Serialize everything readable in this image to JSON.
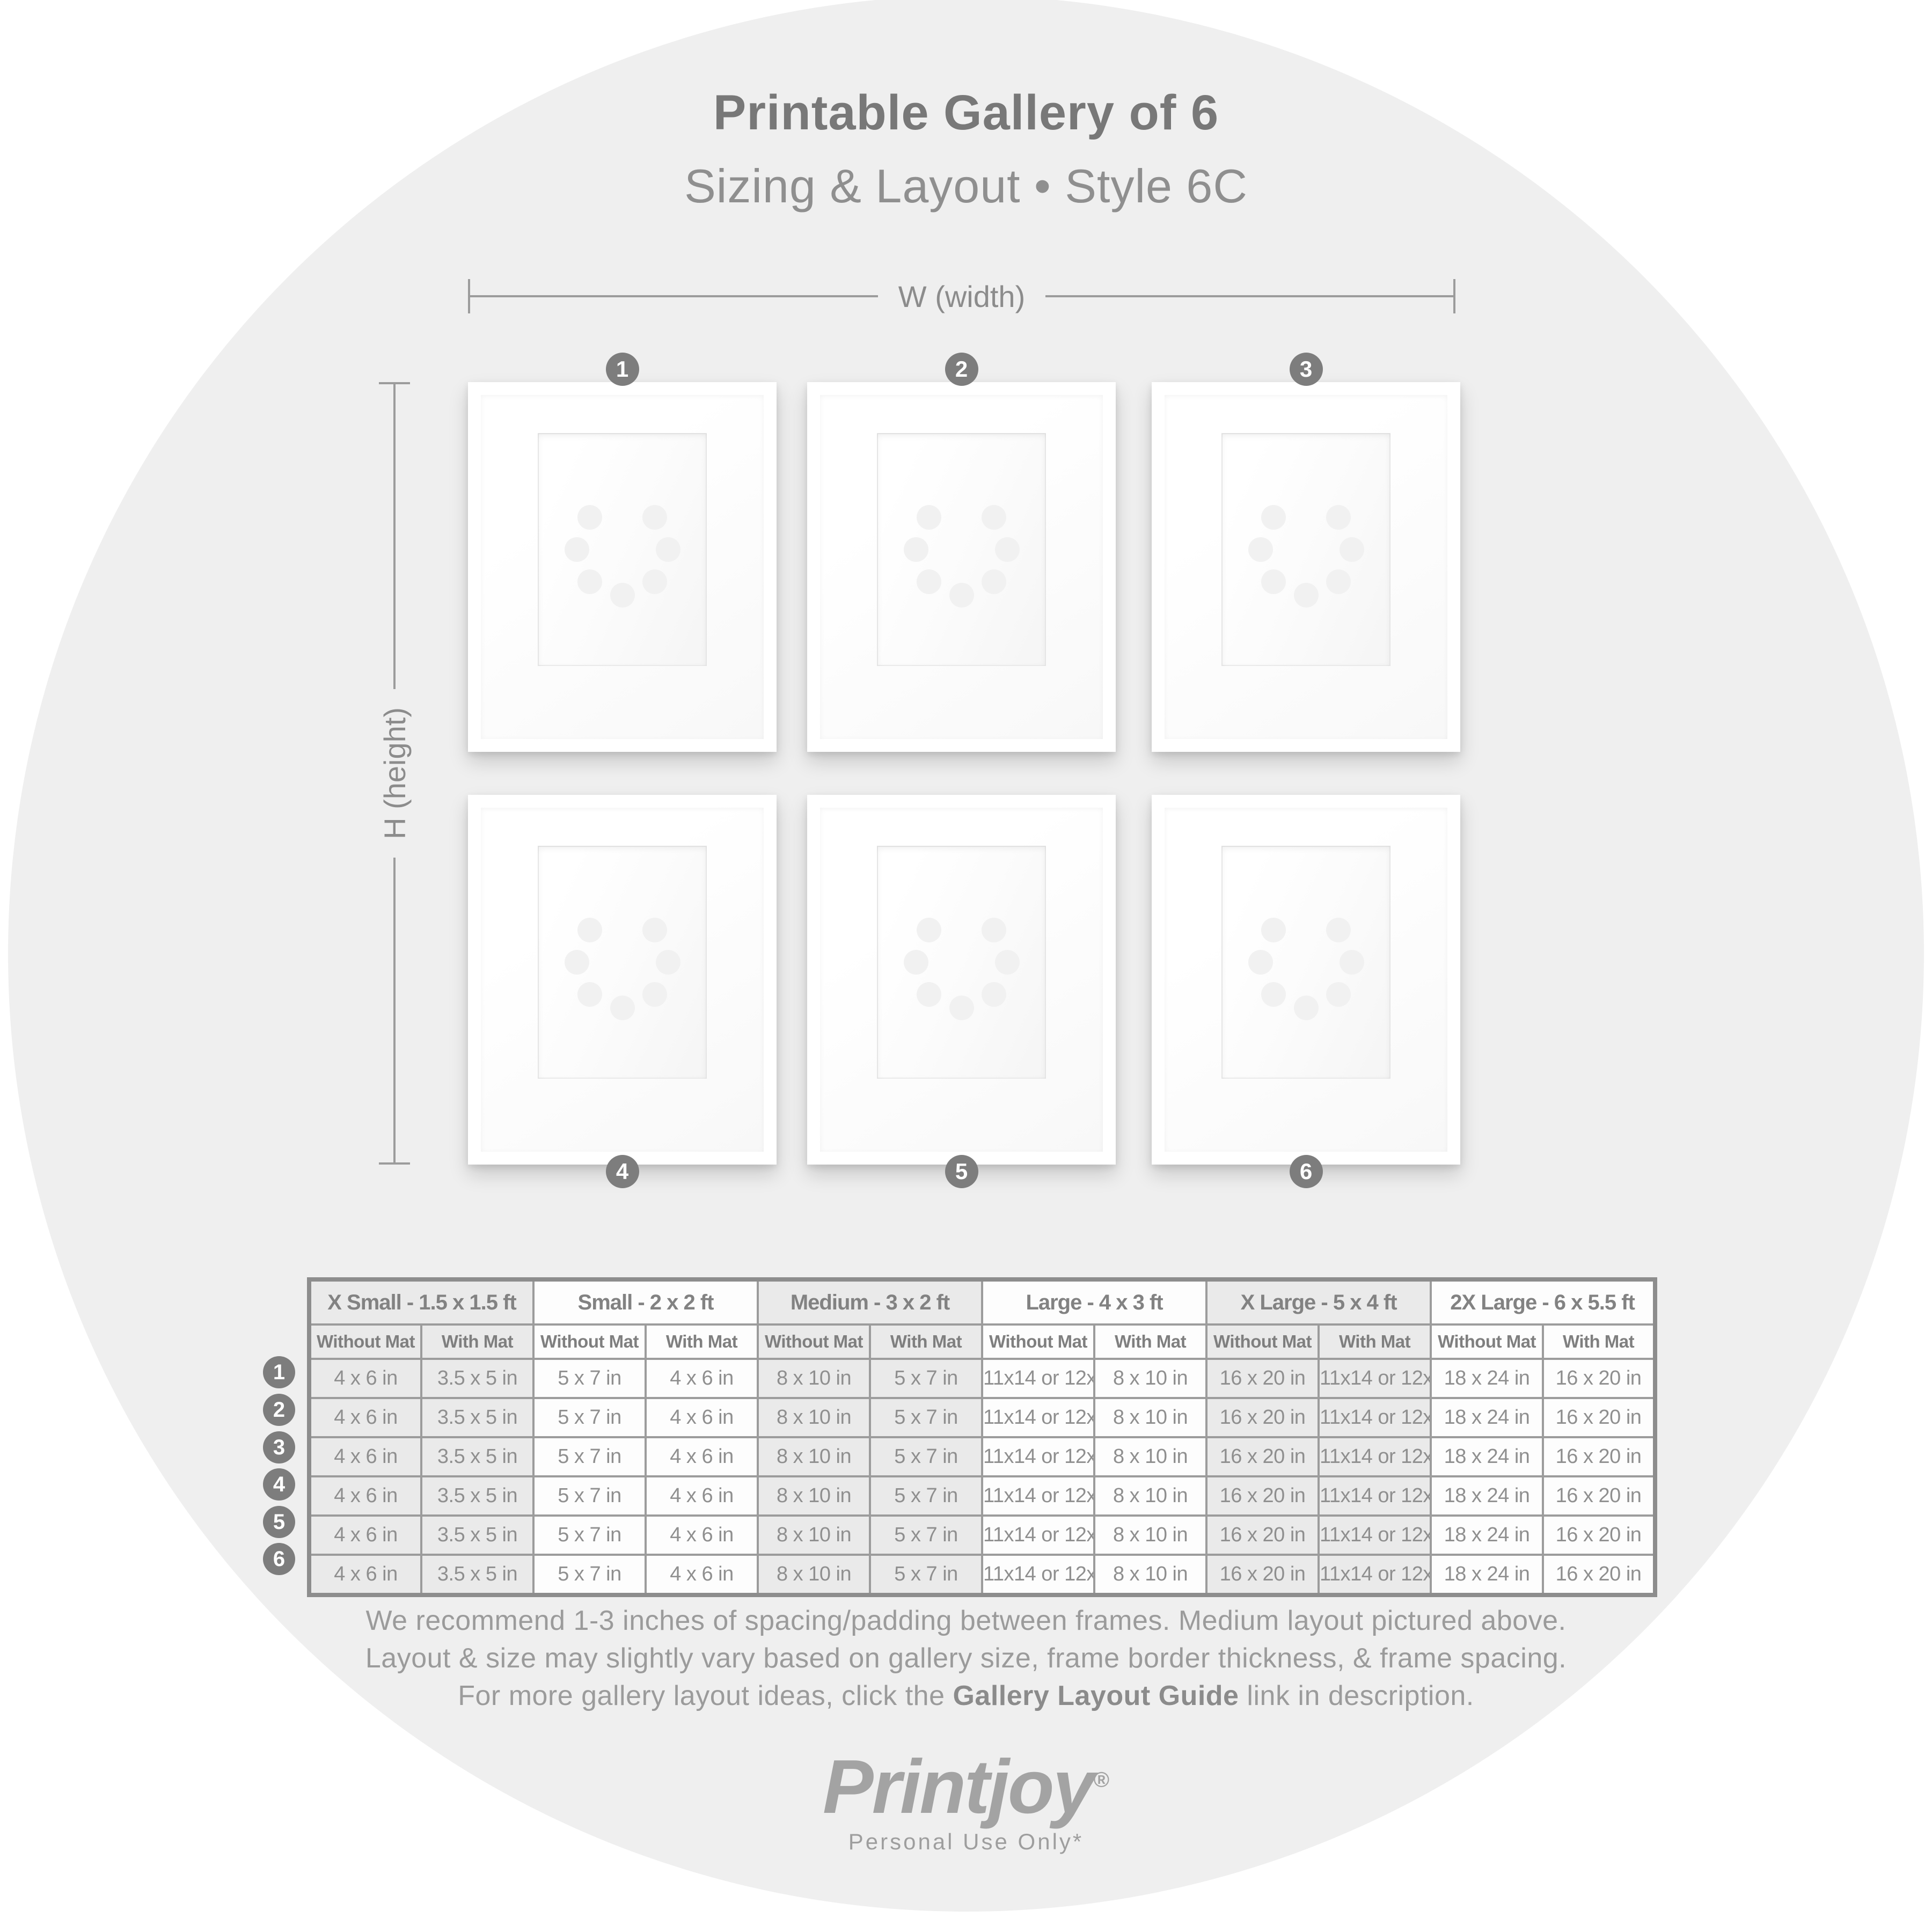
{
  "header": {
    "title": "Printable Gallery of 6",
    "subtitle": "Sizing & Layout • Style 6C"
  },
  "diagram": {
    "width_label": "W (width)",
    "height_label": "H (height)",
    "frames": [
      {
        "number": "1"
      },
      {
        "number": "2"
      },
      {
        "number": "3"
      },
      {
        "number": "4"
      },
      {
        "number": "5"
      },
      {
        "number": "6"
      }
    ]
  },
  "table": {
    "groups": [
      {
        "label": "X Small - 1.5 x 1.5 ft",
        "shaded": true
      },
      {
        "label": "Small - 2 x 2 ft",
        "shaded": false
      },
      {
        "label": "Medium - 3 x 2 ft",
        "shaded": true
      },
      {
        "label": "Large - 4 x 3 ft",
        "shaded": false
      },
      {
        "label": "X Large - 5 x 4 ft",
        "shaded": true
      },
      {
        "label": "2X Large - 6 x 5.5 ft",
        "shaded": false
      }
    ],
    "subheaders": [
      "Without Mat",
      "With Mat"
    ],
    "rows": [
      {
        "number": "1",
        "cells": [
          "4 x 6 in",
          "3.5 x 5 in",
          "5 x 7 in",
          "4 x 6 in",
          "8 x 10 in",
          "5 x 7 in",
          "11x14 or 12x16 in",
          "8 x 10 in",
          "16 x 20 in",
          "11x14 or 12x16 in",
          "18 x 24 in",
          "16 x 20 in"
        ]
      },
      {
        "number": "2",
        "cells": [
          "4 x 6 in",
          "3.5 x 5 in",
          "5 x 7 in",
          "4 x 6 in",
          "8 x 10 in",
          "5 x 7 in",
          "11x14 or 12x16 in",
          "8 x 10 in",
          "16 x 20 in",
          "11x14 or 12x16 in",
          "18 x 24 in",
          "16 x 20 in"
        ]
      },
      {
        "number": "3",
        "cells": [
          "4 x 6 in",
          "3.5 x 5 in",
          "5 x 7 in",
          "4 x 6 in",
          "8 x 10 in",
          "5 x 7 in",
          "11x14 or 12x16 in",
          "8 x 10 in",
          "16 x 20 in",
          "11x14 or 12x16 in",
          "18 x 24 in",
          "16 x 20 in"
        ]
      },
      {
        "number": "4",
        "cells": [
          "4 x 6 in",
          "3.5 x 5 in",
          "5 x 7 in",
          "4 x 6 in",
          "8 x 10 in",
          "5 x 7 in",
          "11x14 or 12x16 in",
          "8 x 10 in",
          "16 x 20 in",
          "11x14 or 12x16 in",
          "18 x 24 in",
          "16 x 20 in"
        ]
      },
      {
        "number": "5",
        "cells": [
          "4 x 6 in",
          "3.5 x 5 in",
          "5 x 7 in",
          "4 x 6 in",
          "8 x 10 in",
          "5 x 7 in",
          "11x14 or 12x16 in",
          "8 x 10 in",
          "16 x 20 in",
          "11x14 or 12x16 in",
          "18 x 24 in",
          "16 x 20 in"
        ]
      },
      {
        "number": "6",
        "cells": [
          "4 x 6 in",
          "3.5 x 5 in",
          "5 x 7 in",
          "4 x 6 in",
          "8 x 10 in",
          "5 x 7 in",
          "11x14 or 12x16 in",
          "8 x 10 in",
          "16 x 20 in",
          "11x14 or 12x16 in",
          "18 x 24 in",
          "16 x 20 in"
        ]
      }
    ]
  },
  "footer": {
    "line1": "We recommend 1-3 inches of spacing/padding between frames. Medium layout pictured above.",
    "line2": "Layout & size may slightly vary based on gallery size, frame border thickness, & frame spacing.",
    "line3_prefix": "For more gallery layout ideas, click the ",
    "line3_bold": "Gallery Layout Guide",
    "line3_suffix": " link in description."
  },
  "brand": {
    "logo": "Printjoy",
    "registered": "®",
    "license": "Personal Use Only*"
  },
  "colors": {
    "background_circle": "#efefef",
    "badge": "#7d7d7d",
    "text_gray": "#8a8a8a",
    "table_border": "#9c9c9c",
    "shaded_cell": "#eaeaea",
    "white_cell": "#fdfdfd"
  }
}
